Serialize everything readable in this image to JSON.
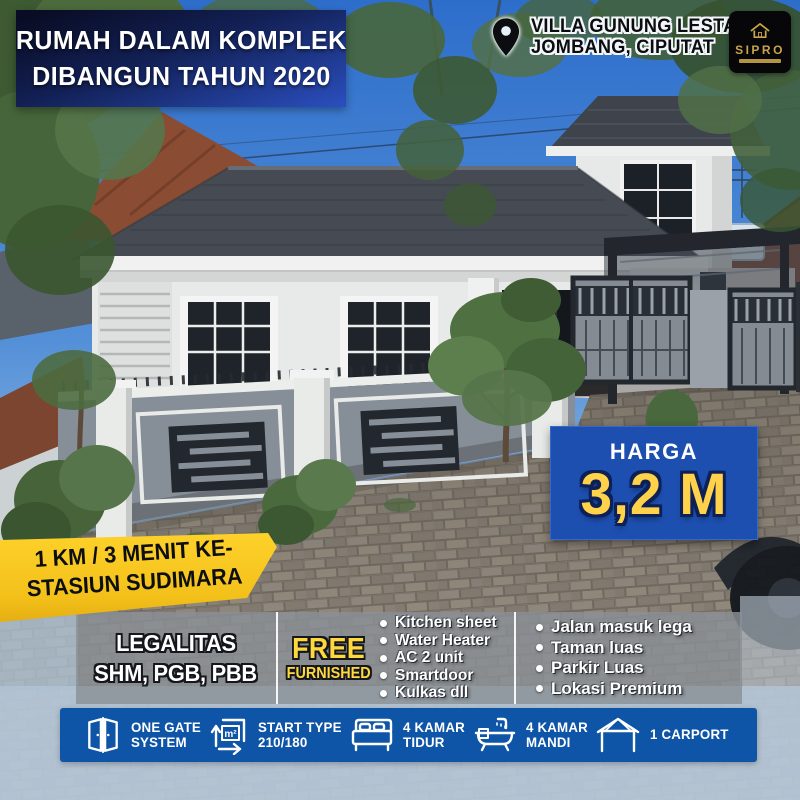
{
  "header": {
    "title": {
      "line1": "RUMAH DALAM KOMPLEK",
      "line2": "DIBANGUN TAHUN 2020"
    },
    "location": {
      "line1": "VILLA GUNUNG LESTARI",
      "line2": "JOMBANG, CIPUTAT"
    },
    "logo_text": "SIPRO"
  },
  "price": {
    "label": "HARGA",
    "value": "3,2 M"
  },
  "distance_ribbon": {
    "line1": "1 KM / 3 MENIT KE-",
    "line2": "STASIUN SUDIMARA"
  },
  "features": {
    "legalitas": {
      "title": "LEGALITAS",
      "value": "SHM, PGB, PBB"
    },
    "free_badge": {
      "line1": "FREE",
      "line2": "FURNISHED"
    },
    "furnished_items": [
      "Kitchen sheet",
      "Water Heater",
      "AC 2 unit",
      "Smartdoor",
      "Kulkas dll"
    ],
    "highlights": [
      "Jalan masuk lega",
      "Taman luas",
      "Parkir Luas",
      "Lokasi Premium"
    ]
  },
  "specs": [
    {
      "icon": "door-icon",
      "line1": "ONE GATE",
      "line2": "SYSTEM"
    },
    {
      "icon": "area-icon",
      "icon_label": "m²",
      "line1": "START TYPE",
      "line2": "210/180"
    },
    {
      "icon": "bed-icon",
      "line1": "4 KAMAR",
      "line2": "TIDUR"
    },
    {
      "icon": "bath-icon",
      "line1": "4 KAMAR",
      "line2": "MANDI"
    },
    {
      "icon": "carport-icon",
      "line1": "1 CARPORT",
      "line2": ""
    }
  ],
  "colors": {
    "banner_blue_dark": "#0a0d28",
    "banner_blue": "#2b4fc0",
    "price_blue": "#1d4fb0",
    "bar_blue": "#0e55a7",
    "accent_yellow": "#ffd24a",
    "ribbon_yellow": "#f3c01a",
    "logo_gold": "#c9a44a"
  }
}
